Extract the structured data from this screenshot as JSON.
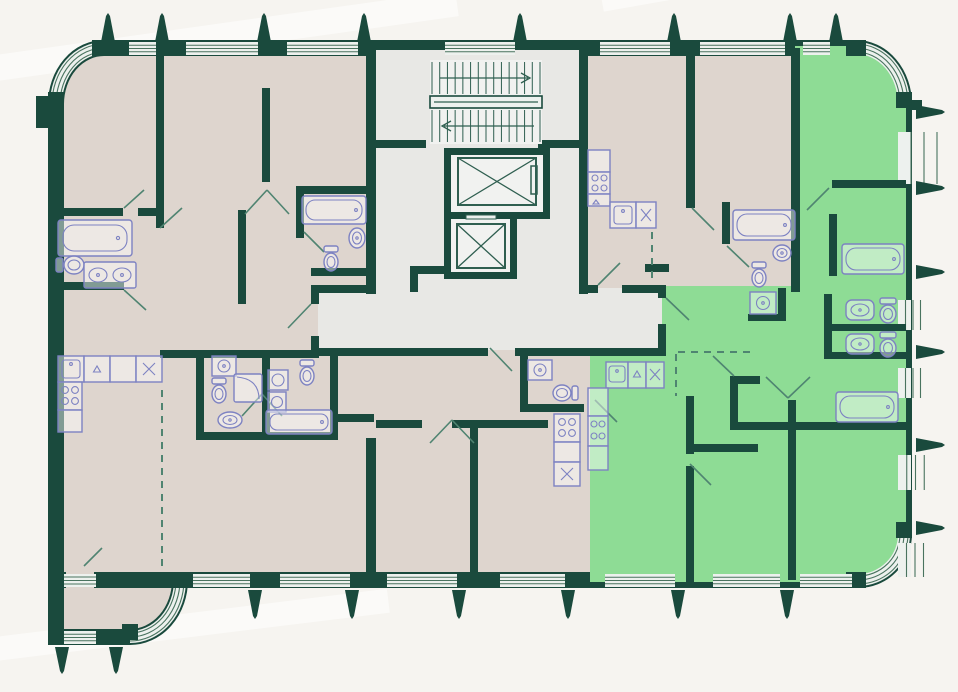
{
  "palette": {
    "background": "#f6f4f0",
    "wall": "#1a4a3d",
    "room_beige": "#ded5ce",
    "core_gray": "#e8e8e5",
    "highlight_green": "#8edc95",
    "window_fill": "#edf1ee",
    "window_stripe": "#49735f",
    "fixture_stroke": "#7d82c2",
    "annotation": "#4f8471",
    "core_line": "#2f5f50"
  },
  "plan": {
    "type": "residential-floor-plan",
    "units": [
      {
        "id": "apartment-left",
        "highlighted": false
      },
      {
        "id": "apartment-middle-top",
        "highlighted": false
      },
      {
        "id": "apartment-middle-bottom",
        "highlighted": false
      },
      {
        "id": "apartment-top-right",
        "highlighted": false
      },
      {
        "id": "apartment-right-green",
        "highlighted": true
      }
    ],
    "core": {
      "stairs": {
        "flights": 2,
        "treads_per_flight": 14,
        "upper_arrow": "right",
        "lower_arrow": "left"
      },
      "elevators": 2
    },
    "fixtures": [
      "bathtub",
      "toilet",
      "sink",
      "double-sink-vanity",
      "corner-shower",
      "kitchen-hob",
      "kitchen-sink",
      "washing-machine"
    ]
  },
  "markers": {
    "spikes": {
      "top_x": [
        108,
        162,
        264,
        364,
        520,
        674,
        790,
        836
      ],
      "right_y": [
        112,
        188,
        272,
        352,
        445,
        528
      ],
      "bottom_x": [
        255,
        352,
        459,
        568,
        678,
        787
      ],
      "protrusion_x": [
        62,
        116
      ]
    },
    "windows": {
      "top": [
        [
          129,
          156
        ],
        [
          186,
          258
        ],
        [
          287,
          358
        ],
        [
          445,
          515
        ],
        [
          600,
          670
        ],
        [
          700,
          785
        ],
        [
          803,
          830
        ]
      ],
      "right": [
        [
          132,
          184
        ],
        [
          300,
          330
        ],
        [
          368,
          398
        ],
        [
          455,
          490
        ],
        [
          543,
          577
        ]
      ],
      "bottom": [
        [
          193,
          250
        ],
        [
          280,
          350
        ],
        [
          387,
          457
        ],
        [
          500,
          565
        ],
        [
          605,
          675
        ],
        [
          713,
          780
        ],
        [
          800,
          852
        ]
      ],
      "protrusion": [
        [
          64,
          96
        ]
      ]
    }
  }
}
